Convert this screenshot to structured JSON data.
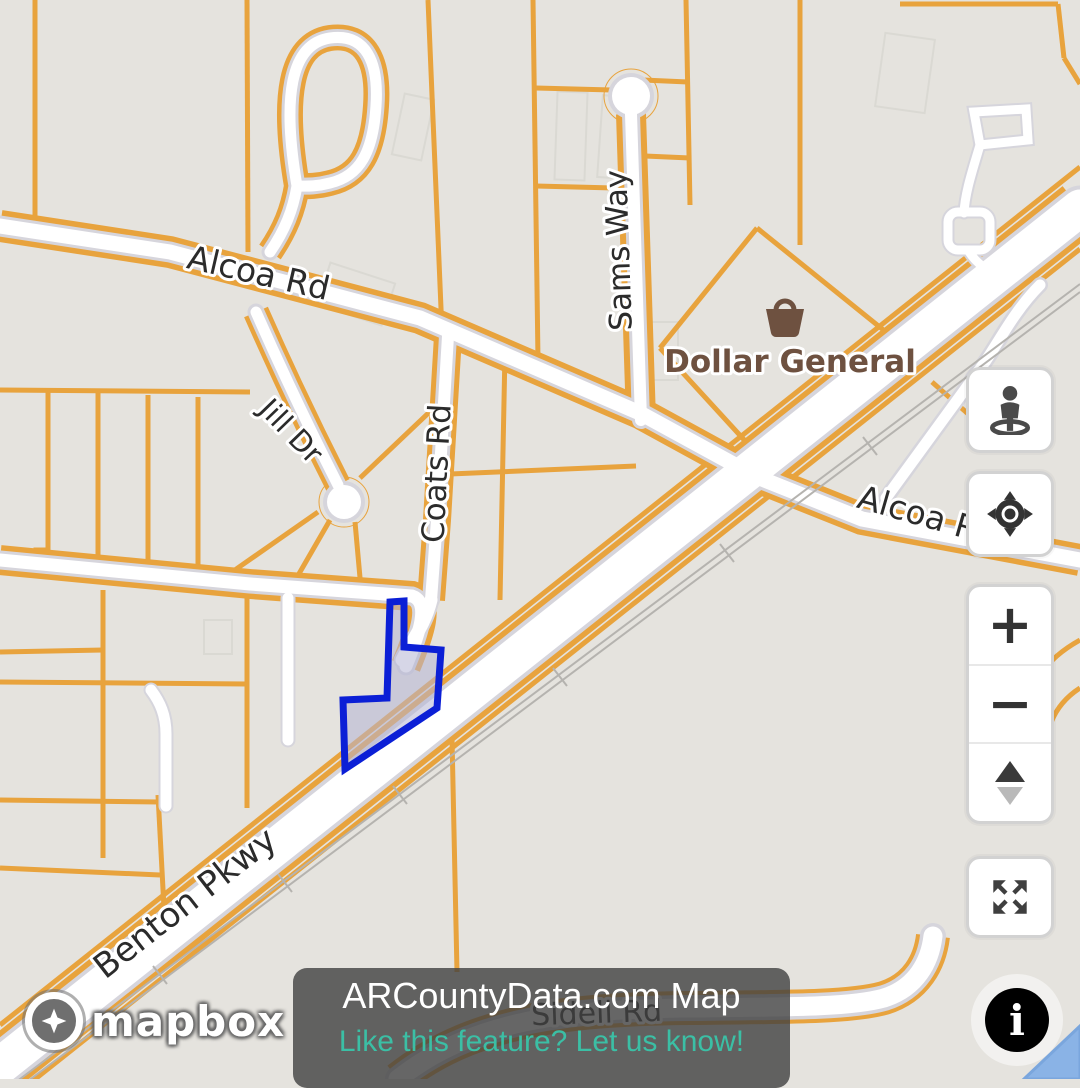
{
  "banner": {
    "title": "ARCountyData.com Map",
    "subtitle": "Like this feature? Let us know!"
  },
  "attribution": {
    "brand": "mapbox"
  },
  "labels": {
    "alcoa_west": "Alcoa Rd",
    "alcoa_east": "Alcoa Rd",
    "sams_way": "Sams Way",
    "coats_rd": "Coats Rd",
    "jill_dr": "Jill Dr",
    "benton_pkwy": "Benton Pkwy",
    "sidell_rd": "Sidell Rd"
  },
  "poi": {
    "dollar_general": {
      "name": "Dollar General",
      "icon": "shopping-basket-icon"
    }
  },
  "controls": {
    "zoom_in": "+",
    "zoom_out": "−",
    "info": "i"
  },
  "colors": {
    "background": "#e5e3de",
    "parcel_line_orange": "#e8a33d",
    "road_fill": "#ffffff",
    "road_casing": "#d6d5dc",
    "railroad_gray": "#b5b3af",
    "label_black": "#2b2b2b",
    "poi_brown": "#6e5140",
    "highlight_parcel_stroke": "#0b1fd6",
    "highlight_parcel_fill": "#b4b4d3",
    "water_blue": "#8ab3e6",
    "banner_teal": "#3bbfa5"
  }
}
